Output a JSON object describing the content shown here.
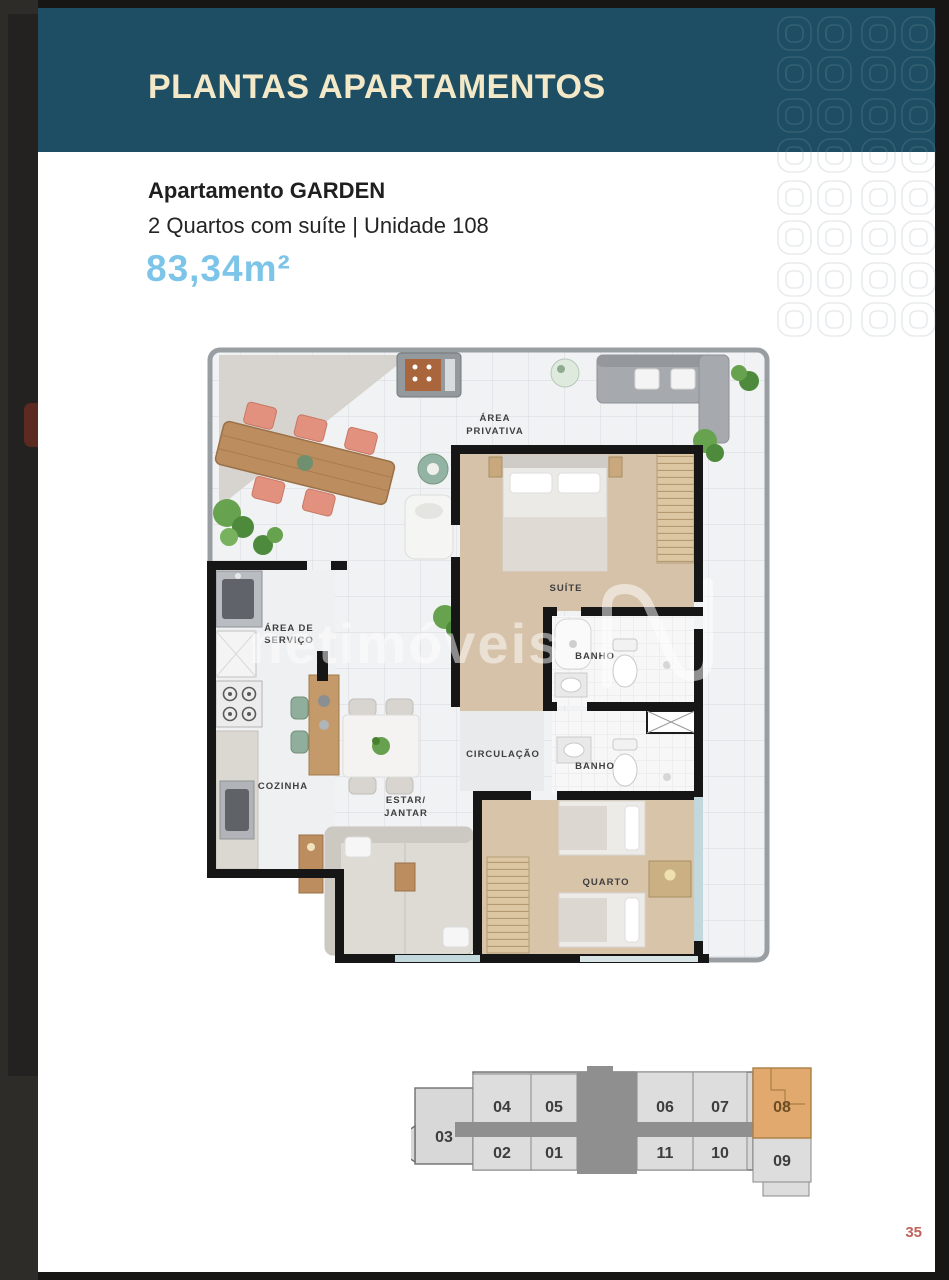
{
  "header": {
    "title": "PLANTAS APARTAMENTOS"
  },
  "apartment": {
    "name": "Apartamento GARDEN",
    "details": "2 Quartos com suíte | Unidade 108",
    "area": "83,34m²"
  },
  "floorplan": {
    "watermark": {
      "brand": "netimóveis",
      "logo": "n-monogram"
    },
    "rooms": {
      "area_privativa_l1": "ÁREA",
      "area_privativa_l2": "PRIVATIVA",
      "suite": "SUÍTE",
      "banho_suite": "BANHO",
      "banho_social": "BANHO",
      "circulacao": "CIRCULAÇÃO",
      "area_servico_l1": "ÁREA DE",
      "area_servico_l2": "SERVIÇO",
      "cozinha": "COZINHA",
      "estar_jantar_l1": "ESTAR/",
      "estar_jantar_l2": "JANTAR",
      "quarto": "QUARTO"
    }
  },
  "keyplan": {
    "left_unit": "03",
    "top_units": [
      "04",
      "05",
      "06",
      "07",
      "08"
    ],
    "bottom_units": [
      "02",
      "01",
      "11",
      "10",
      "09"
    ],
    "highlighted_unit": "08"
  },
  "colors": {
    "header_bg": "#1d4e63",
    "header_title": "#f3e8c7",
    "area_text": "#7cc5e9",
    "keyplan_highlight": "#e2a96e",
    "page_number": "#c0625b"
  },
  "page": {
    "number": "35"
  }
}
